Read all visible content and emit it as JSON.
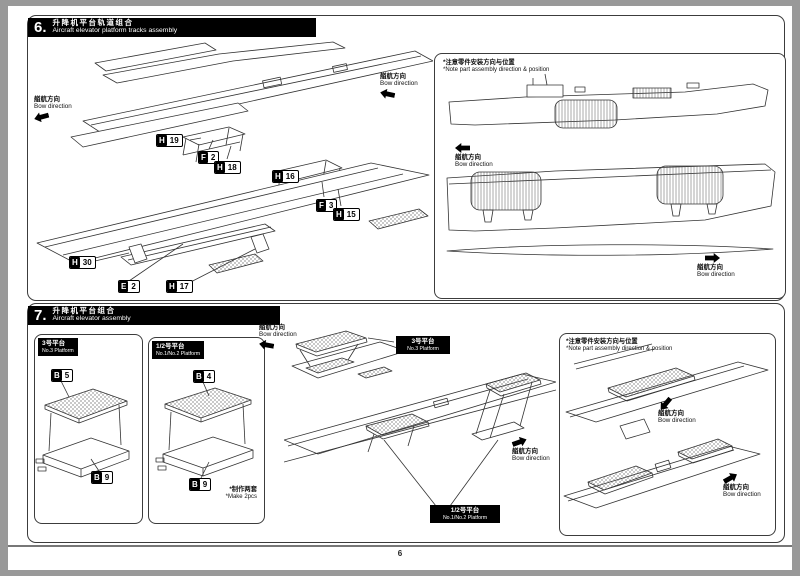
{
  "page": {
    "number": "6"
  },
  "common": {
    "bow_zh": "艏航方向",
    "bow_en": "Bow direction",
    "note_zh": "*注意零件安装方向与位置",
    "note_en": "*Note part assembly direction & position"
  },
  "step6": {
    "number": "6.",
    "title_zh": "升降机平台轨道组合",
    "title_en": "Aircraft elevator platform tracks assembly",
    "parts": [
      {
        "letter": "H",
        "number": "19"
      },
      {
        "letter": "F",
        "number": "2"
      },
      {
        "letter": "H",
        "number": "18"
      },
      {
        "letter": "H",
        "number": "16"
      },
      {
        "letter": "F",
        "number": "3"
      },
      {
        "letter": "H",
        "number": "15"
      },
      {
        "letter": "H",
        "number": "30"
      },
      {
        "letter": "E",
        "number": "2"
      },
      {
        "letter": "H",
        "number": "17"
      }
    ]
  },
  "step7": {
    "number": "7.",
    "title_zh": "升降机平台组合",
    "title_en": "Aircraft elevator assembly",
    "box1": {
      "tag_zh": "3号平台",
      "tag_en": "No.3 Platform",
      "parts": [
        {
          "letter": "B",
          "number": "5"
        },
        {
          "letter": "B",
          "number": "9"
        }
      ]
    },
    "box2": {
      "tag_zh": "1/2号平台",
      "tag_en": "No.1/No.2 Platform",
      "parts": [
        {
          "letter": "B",
          "number": "4"
        },
        {
          "letter": "B",
          "number": "9"
        }
      ],
      "qty_zh": "*制作两套",
      "qty_en": "*Make 2pcs"
    },
    "tags": {
      "no3_zh": "3号平台",
      "no3_en": "No.3 Platform",
      "no12_zh": "1/2号平台",
      "no12_en": "No.1/No.2 Platform"
    }
  }
}
